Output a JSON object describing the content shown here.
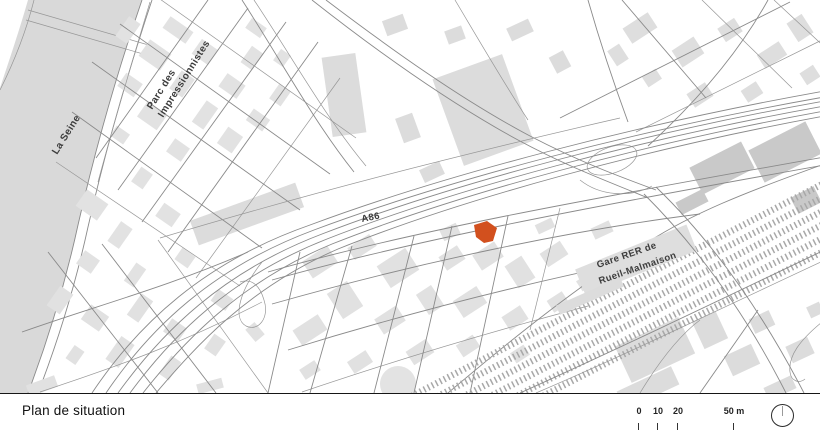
{
  "header": {
    "title": "Plan de situation"
  },
  "map": {
    "labels": {
      "river": "La Seine",
      "park": {
        "line1": "Parc des",
        "line2": "Impressionnistes"
      },
      "highway": "A86",
      "station": {
        "line1": "Gare RER de",
        "line2": "Rueil-Malmaison"
      }
    },
    "site_marker_color": "#d2501e"
  },
  "scalebar": {
    "ticks": [
      "0",
      "10",
      "20"
    ],
    "end_label": "50 m"
  },
  "colors": {
    "site_accent": "#d2501e",
    "building": "#e2e2e2",
    "building_dark": "#c9c9c9",
    "water": "#d9d9d9",
    "road_line": "#8a8a8a",
    "rail": "#a8a8a8",
    "divider": "#161616",
    "text": "#111111"
  }
}
